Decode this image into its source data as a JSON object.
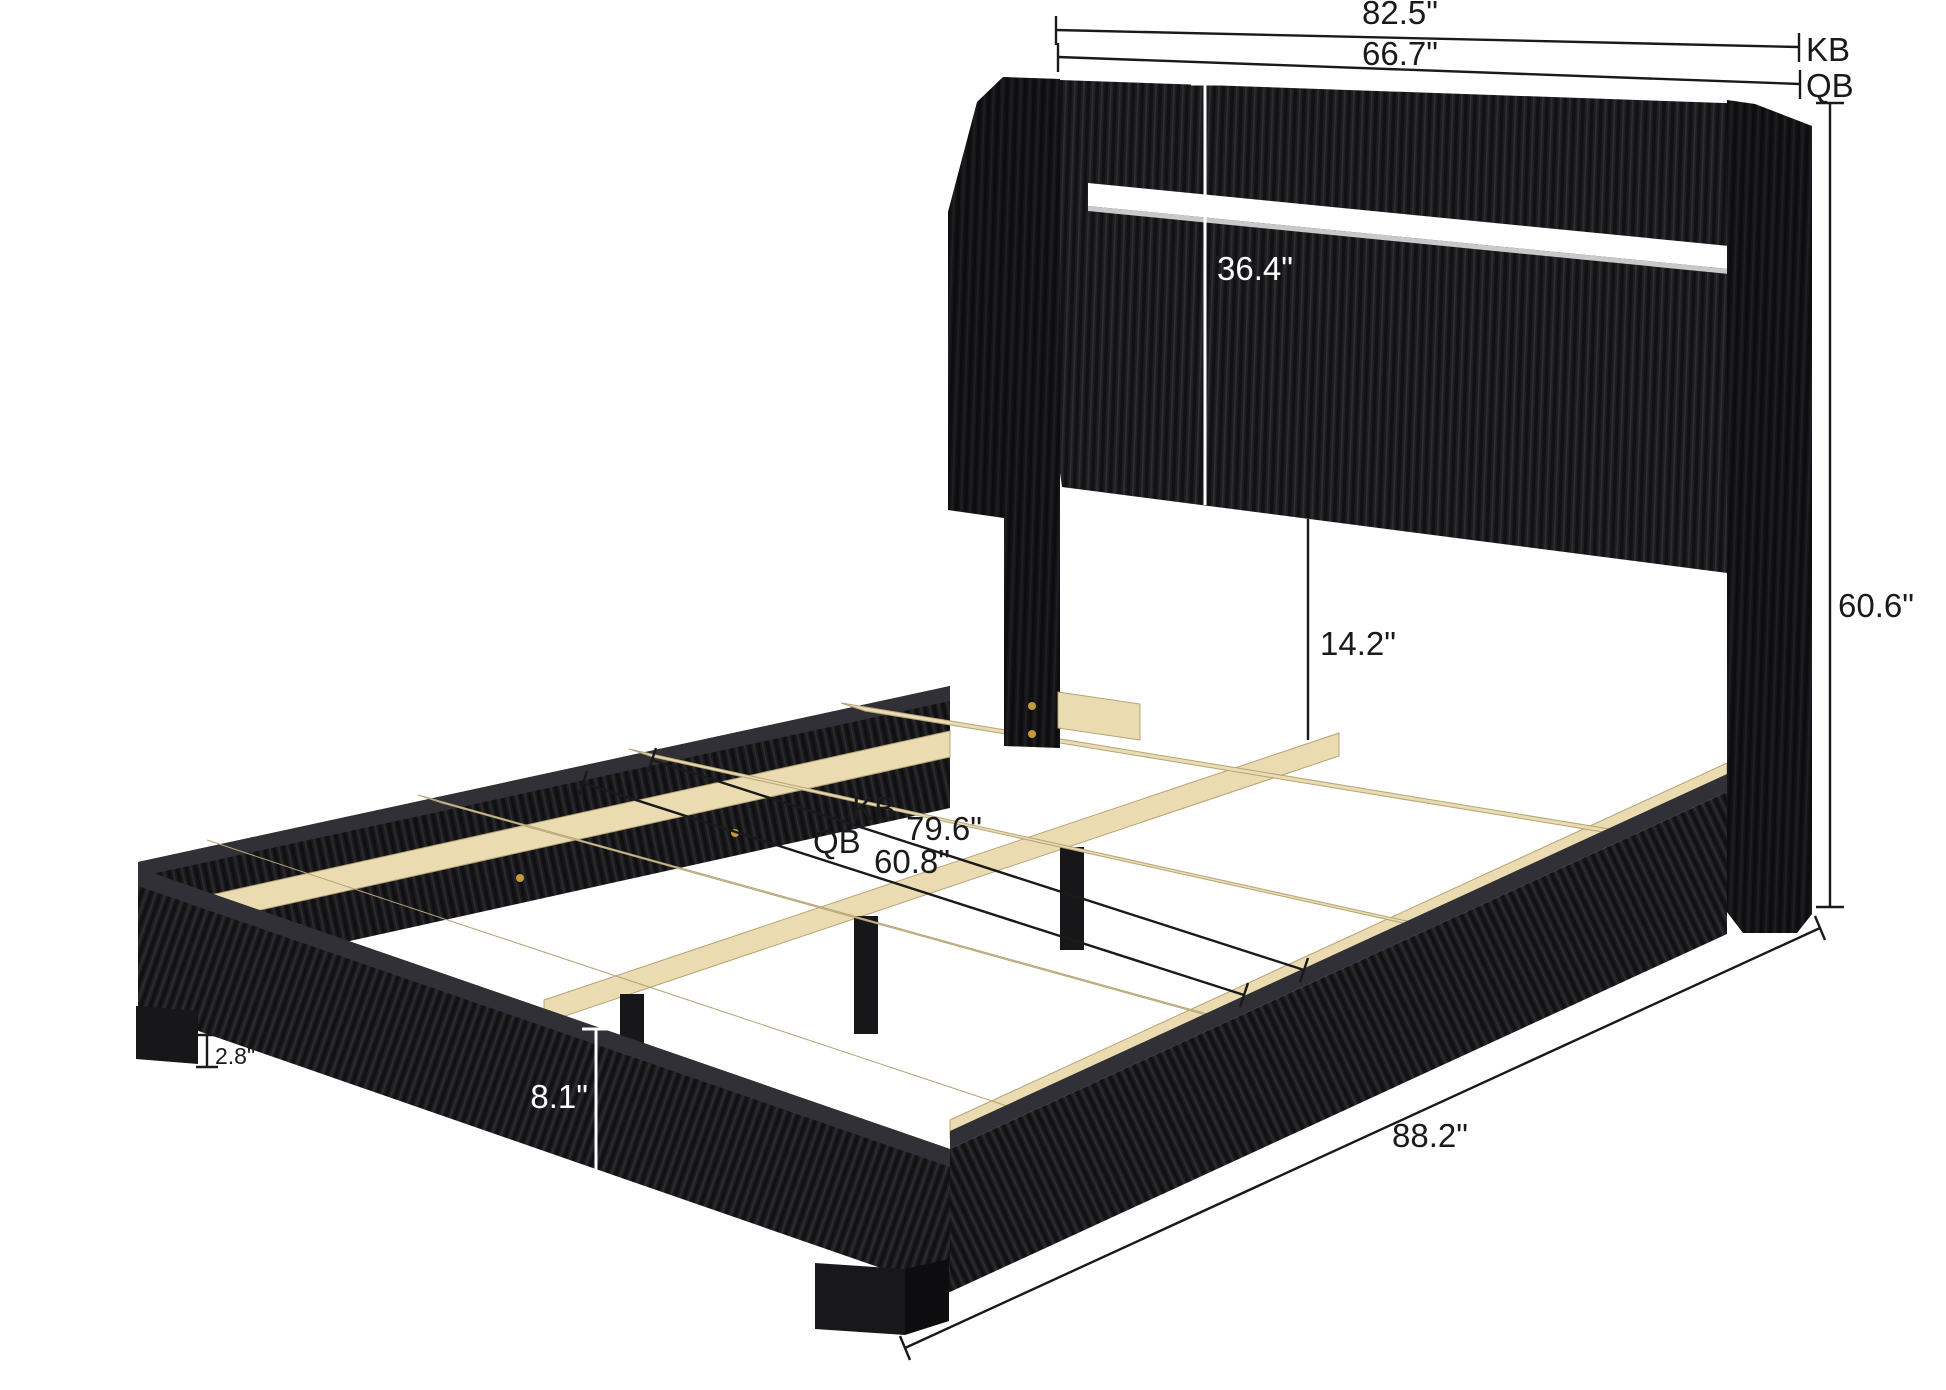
{
  "diagram": {
    "subject": "Black corduroy upholstered platform bed with LED strip headboard and wood slats",
    "view": "three-quarter perspective dimension diagram",
    "units": "inches",
    "size_variants": [
      "KB",
      "QB"
    ]
  },
  "dimensions": {
    "kb_headboard_width": {
      "value": "82.5\"",
      "tag": "KB"
    },
    "qb_headboard_width": {
      "value": "66.7\"",
      "tag": "QB"
    },
    "headboard_panel_height": {
      "value": "36.4\""
    },
    "headboard_bottom_to_slats": {
      "value": "14.2\""
    },
    "overall_height": {
      "value": "60.6\""
    },
    "kb_interior_length": {
      "tag": "KB",
      "value": "79.6\""
    },
    "qb_interior_width": {
      "tag": "QB",
      "value": "60.8\""
    },
    "side_rail_height": {
      "value": "8.1\""
    },
    "leg_height": {
      "value": "2.8\""
    },
    "overall_length": {
      "value": "88.2\""
    }
  },
  "colors": {
    "background": "#ffffff",
    "fabric_dark": "#1e1e21",
    "fabric_rib_shadow": "#121215",
    "fabric_rib_highlight": "#2d2d33",
    "wood": "#eadcb0",
    "wood_edge": "#b5a478",
    "hardware_gold": "#c49a3c",
    "dimension_line": "#1a1a1a",
    "led_strip": "#ffffff"
  }
}
